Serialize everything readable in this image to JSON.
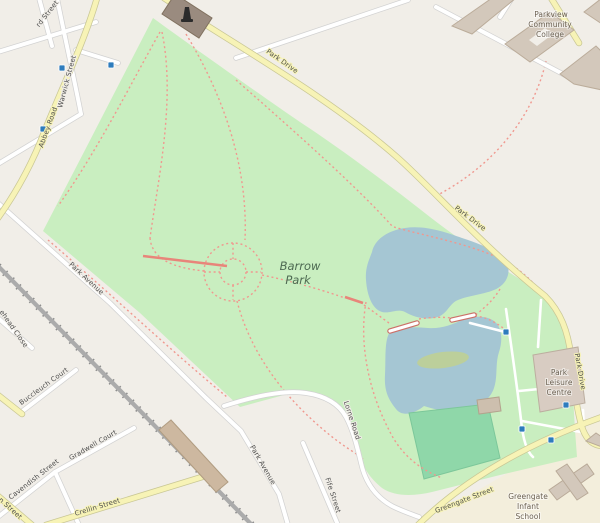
{
  "map": {
    "kind": "openstreetmap-style park map",
    "place_labels": {
      "park": [
        "Barrow",
        "Park"
      ],
      "college": [
        "Parkview",
        "Community",
        "College"
      ],
      "leisure_centre": [
        "Park",
        "Leisure",
        "Centre"
      ],
      "school": [
        "Greengate",
        "Infant",
        "School"
      ]
    },
    "street_labels": {
      "park_drive": "Park Drive",
      "abbey_road": "Abbey Road",
      "warwick_street": "Warwick Street",
      "rd_street_partial": "rd Street",
      "park_avenue": "Park Avenue",
      "lorne_road": "Lorne Road",
      "fife_street": "Fife Street",
      "greengate_street": "Greengate Street",
      "crellin_street": "Crellin Street",
      "cavendish_street": "Cavendish Street",
      "gradwell_court": "Gradwell Court",
      "buccleuch_court": "Buccleuch Court",
      "ehead_close_partial": "ehead Close",
      "n_street_partial": "n Street"
    },
    "features": {
      "lake": "boating lake with island and two footbridges",
      "pitch": "sports pitch",
      "railway": "railway line",
      "monument": "monument building with statue icon"
    },
    "markers": {
      "bus_stops": 3,
      "park_blue_markers": 4
    },
    "colors": {
      "background": "#f1eee8",
      "park_green": "#c9eec0",
      "water_blue": "#a5c6d3",
      "island_olive": "#bccf9b",
      "pitch_green": "#8fd7a9",
      "road_yellow": "#f7f3b6",
      "road_white": "#ffffff",
      "footpath_pink": "#f0988f",
      "building_gray": "#d3c8bb",
      "building_tan": "#cdb8a0",
      "leisure_building": "#d8ccc2",
      "marker_blue": "#2e7cbd",
      "railway_gray": "#ababab"
    }
  }
}
